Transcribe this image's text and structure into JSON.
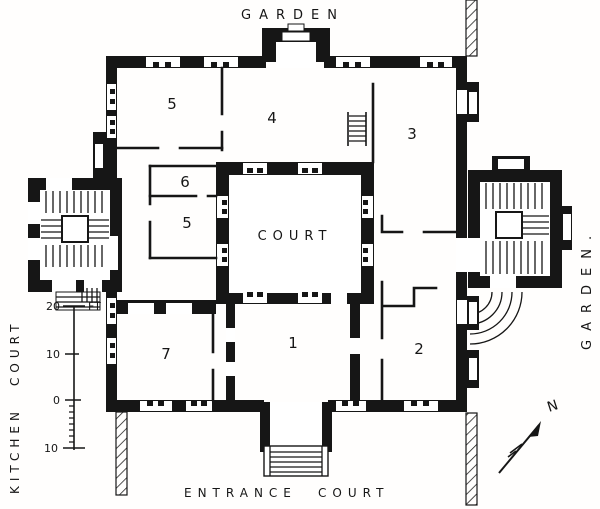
{
  "colors": {
    "ink": "#161616",
    "paper": "#ffffff"
  },
  "labels": {
    "garden_top": "GARDEN",
    "garden_right": "GARDEN.",
    "kitchen_court_word1": "KITCHEN",
    "kitchen_court_word2": "COURT",
    "entrance_court_word1": "ENTRANCE",
    "entrance_court_word2": "COURT",
    "court": "COURT",
    "north": "N"
  },
  "room_numbers": [
    "5",
    "4",
    "3",
    "6",
    "5",
    "7",
    "1",
    "2"
  ],
  "scale_bar": {
    "unit": "FT",
    "tick_labels": [
      "20",
      "10",
      "0",
      "10"
    ]
  }
}
